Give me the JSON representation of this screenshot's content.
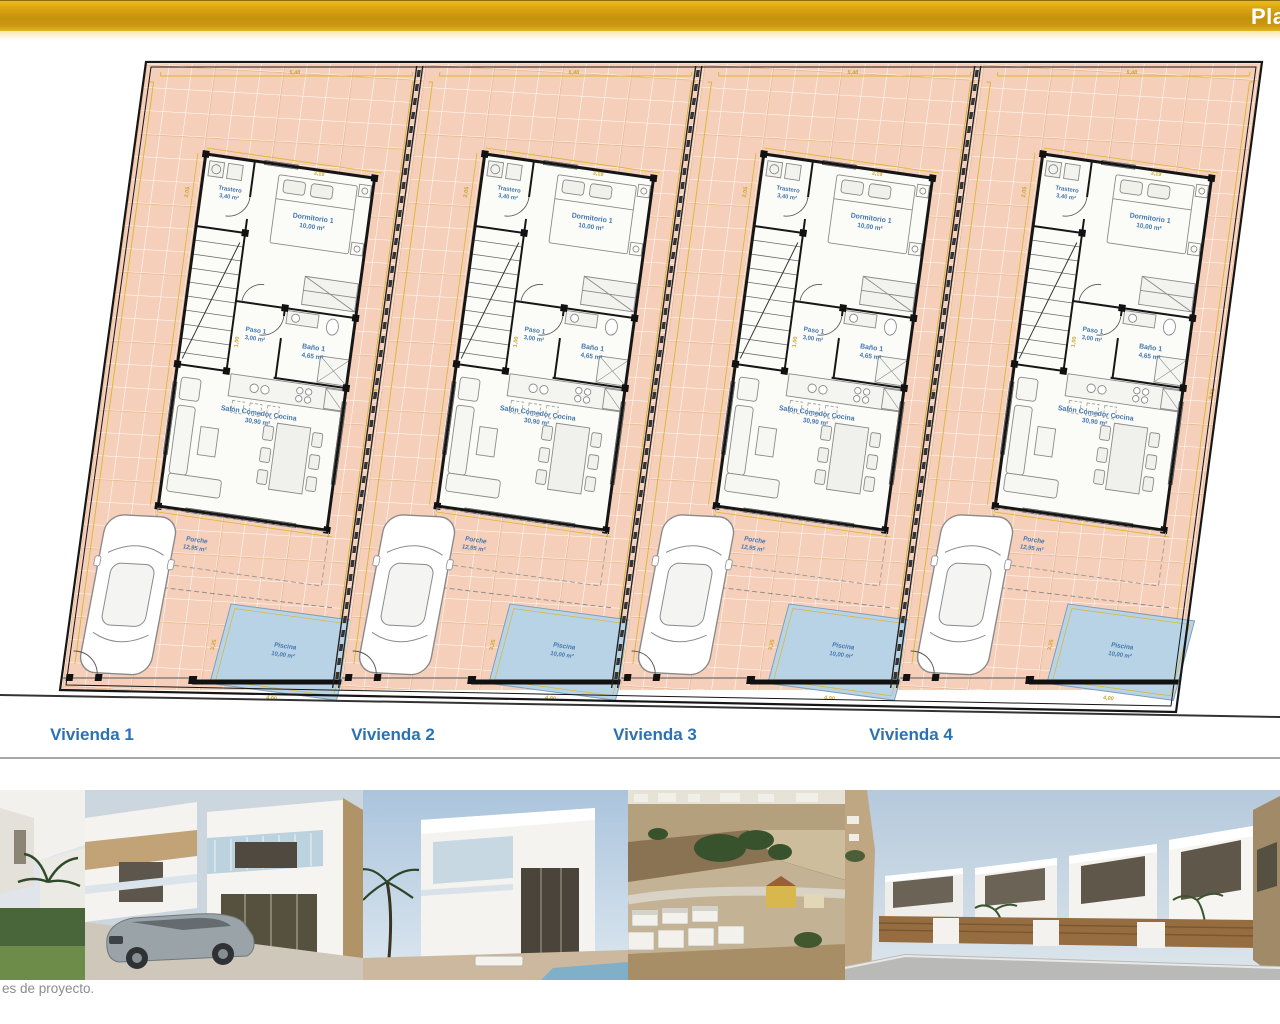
{
  "header": {
    "title_partial": "Pla",
    "bar_color_top": "#eaba1e",
    "bar_color_bottom": "#c3910b"
  },
  "plan": {
    "units": [
      {
        "name": "Vivienda 1"
      },
      {
        "name": "Vivienda 2"
      },
      {
        "name": "Vivienda 3"
      },
      {
        "name": "Vivienda 4"
      }
    ],
    "rooms": {
      "trastero": {
        "name": "Trastero",
        "area": "3,40 m²"
      },
      "dormitorio": {
        "name": "Dormitorio 1",
        "area": "10,00 m²"
      },
      "paso": {
        "name": "Paso 1",
        "area": "3,00 m²"
      },
      "bano": {
        "name": "Baño 1",
        "area": "4,65 m²"
      },
      "salon": {
        "name": "Salón Comedor Cocina",
        "area": "30,90 m²"
      },
      "porche": {
        "name": "Porche",
        "area": "12,95 m²"
      },
      "piscina": {
        "name": "Piscina",
        "area": "10,00 m²"
      }
    },
    "dimensions": {
      "plot_top": "5,48",
      "plot_right": "9,66",
      "bed_top": "3,19",
      "trastero_side": "2,05",
      "paso_side": "1,00",
      "pool_width": "4,00",
      "pool_height": "3,25",
      "porch_side": "1,50"
    },
    "colors": {
      "plot_fill": "#f6cfba",
      "grid_line": "#ffffff",
      "tan_grid_line": "#e3b07c",
      "wall": "#161616",
      "room_label": "#4377b0",
      "vivienda_label": "#2c72b2",
      "dimension": "#c9a52a",
      "pool_fill": "#b9d3e6",
      "furniture_line": "#777777"
    }
  },
  "gallery": {
    "caption": "es de proyecto.",
    "photo_count": 5
  }
}
